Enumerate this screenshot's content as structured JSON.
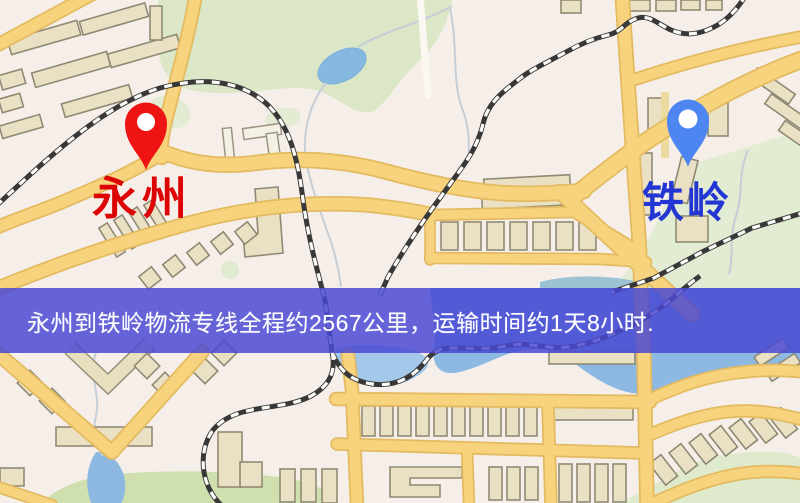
{
  "map": {
    "origin_marker": {
      "label": "永州",
      "pin_color": "#ee1414",
      "label_color": "#dc0404"
    },
    "destination_marker": {
      "label": "铁岭",
      "pin_color": "#4d86f3",
      "label_color": "#2336d4"
    }
  },
  "banner": {
    "text": "永州到铁岭物流专线全程约2567公里，运输时间约1天8小时.",
    "origin": "永州",
    "destination": "铁岭",
    "distance_km": "2567",
    "duration": "1天8小时",
    "background_color": "#4947d3",
    "text_color": "#ffffff"
  }
}
